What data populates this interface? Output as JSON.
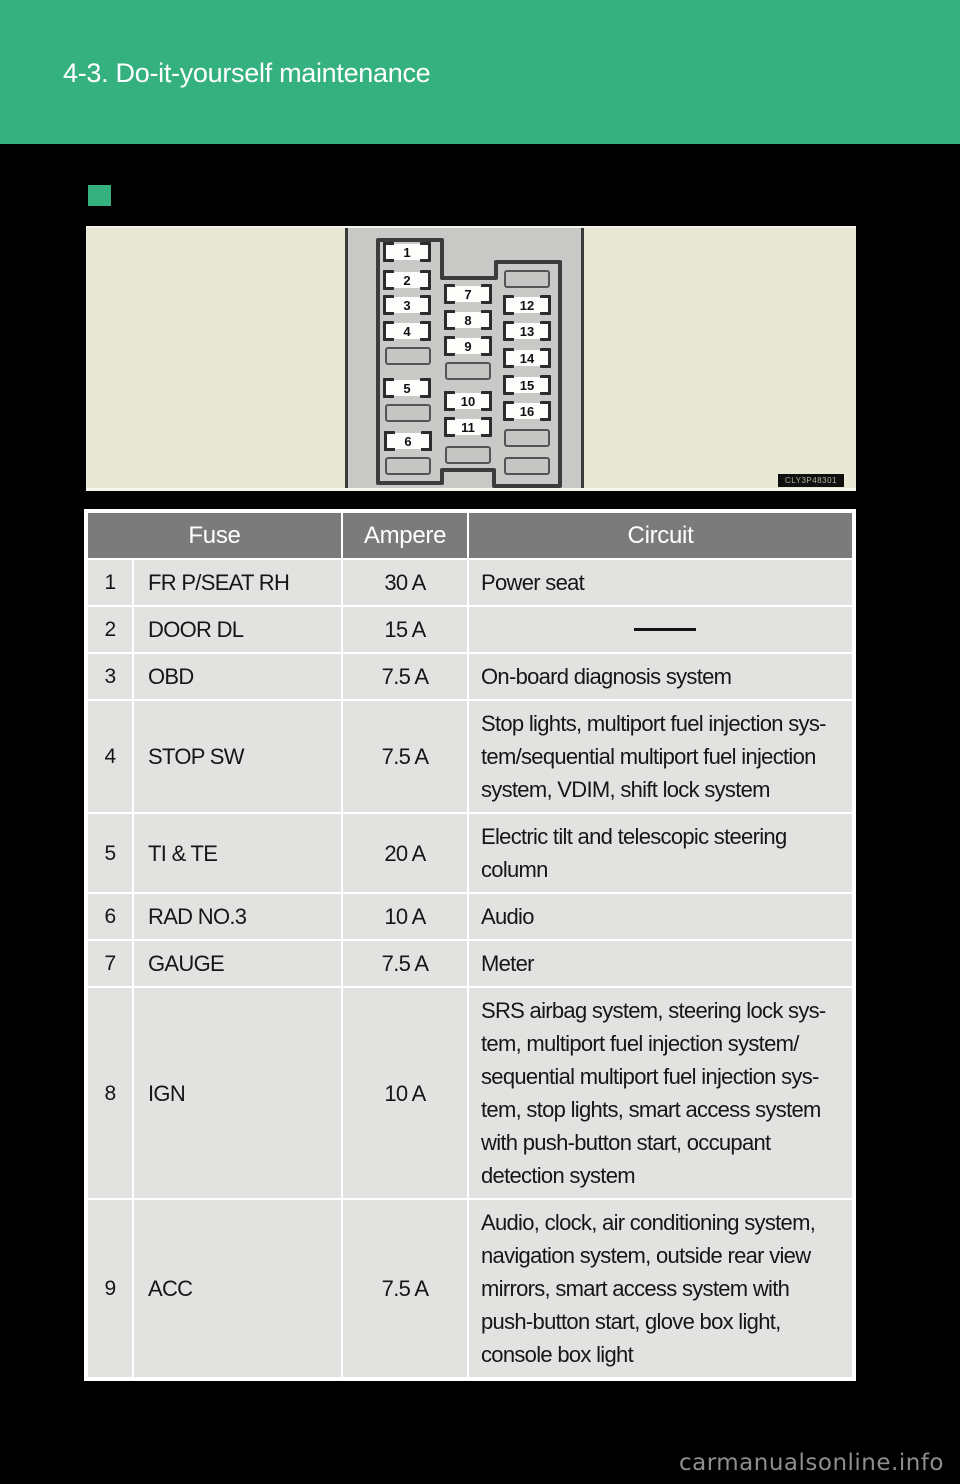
{
  "header": {
    "title": "4-3. Do-it-yourself maintenance"
  },
  "colors": {
    "accent_green": "#34b17e",
    "page_background": "#000000",
    "table_header_gray": "#7b7b7b",
    "table_cell_gray": "#e2e2e0",
    "diagram_beige": "#e9e8d7",
    "panel_gray": "#c9c9c7"
  },
  "diagram": {
    "code": "CLY3P48301",
    "slots": [
      {
        "label": "1",
        "cx": 321,
        "cy": 24
      },
      {
        "label": "2",
        "cx": 321,
        "cy": 52
      },
      {
        "label": "3",
        "cx": 321,
        "cy": 77
      },
      {
        "label": "4",
        "cx": 321,
        "cy": 103
      },
      {
        "label": null,
        "cx": 322,
        "cy": 128
      },
      {
        "label": "5",
        "cx": 321,
        "cy": 160
      },
      {
        "label": null,
        "cx": 322,
        "cy": 185
      },
      {
        "label": "6",
        "cx": 322,
        "cy": 213
      },
      {
        "label": null,
        "cx": 322,
        "cy": 238
      },
      {
        "label": "7",
        "cx": 382,
        "cy": 66
      },
      {
        "label": "8",
        "cx": 382,
        "cy": 92
      },
      {
        "label": "9",
        "cx": 382,
        "cy": 118
      },
      {
        "label": null,
        "cx": 382,
        "cy": 143
      },
      {
        "label": "10",
        "cx": 382,
        "cy": 173
      },
      {
        "label": "11",
        "cx": 382,
        "cy": 199
      },
      {
        "label": null,
        "cx": 382,
        "cy": 227
      },
      {
        "label": null,
        "cx": 441,
        "cy": 51
      },
      {
        "label": "12",
        "cx": 441,
        "cy": 77
      },
      {
        "label": "13",
        "cx": 441,
        "cy": 103
      },
      {
        "label": "14",
        "cx": 441,
        "cy": 130
      },
      {
        "label": "15",
        "cx": 441,
        "cy": 157
      },
      {
        "label": "16",
        "cx": 441,
        "cy": 183
      },
      {
        "label": null,
        "cx": 441,
        "cy": 210
      },
      {
        "label": null,
        "cx": 441,
        "cy": 238
      }
    ]
  },
  "table": {
    "headers": {
      "fuse": "Fuse",
      "ampere": "Ampere",
      "circuit": "Circuit"
    },
    "rows": [
      {
        "num": "1",
        "fuse": "FR P/SEAT RH",
        "ampere": "30 A",
        "circuit": "Power seat"
      },
      {
        "num": "2",
        "fuse": "DOOR DL",
        "ampere": "15 A",
        "circuit": "—"
      },
      {
        "num": "3",
        "fuse": "OBD",
        "ampere": "7.5 A",
        "circuit": "On-board diagnosis system"
      },
      {
        "num": "4",
        "fuse": "STOP SW",
        "ampere": "7.5 A",
        "circuit": "Stop lights, multiport fuel injection sys-\ntem/sequential multiport fuel injection\nsystem, VDIM, shift lock system"
      },
      {
        "num": "5",
        "fuse": "TI & TE",
        "ampere": "20 A",
        "circuit": "Electric tilt and telescopic steering\ncolumn"
      },
      {
        "num": "6",
        "fuse": "RAD NO.3",
        "ampere": "10 A",
        "circuit": "Audio"
      },
      {
        "num": "7",
        "fuse": "GAUGE",
        "ampere": "7.5 A",
        "circuit": "Meter"
      },
      {
        "num": "8",
        "fuse": "IGN",
        "ampere": "10 A",
        "circuit": "SRS airbag system, steering lock sys-\ntem, multiport fuel injection system/\nsequential multiport fuel injection sys-\ntem, stop lights, smart access system\nwith push-button start, occupant\ndetection system"
      },
      {
        "num": "9",
        "fuse": "ACC",
        "ampere": "7.5 A",
        "circuit": "Audio, clock, air conditioning system,\nnavigation system, outside rear view\nmirrors, smart access system with\npush-button start, glove box light,\nconsole box light"
      }
    ]
  },
  "footer": {
    "watermark": "carmanualsonline.info"
  }
}
